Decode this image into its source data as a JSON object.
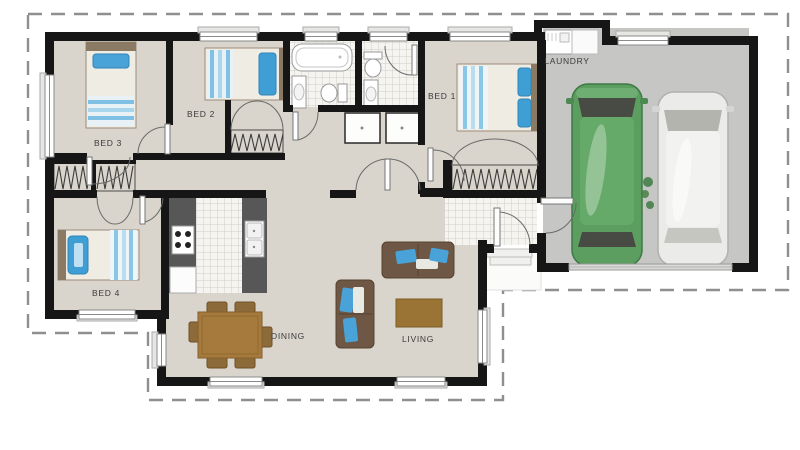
{
  "title": "Single storey house floor plan with double garage",
  "rooms": {
    "bed1": "BED 1",
    "bed2": "BED 2",
    "bed3": "BED 3",
    "bed4": "BED 4",
    "dining": "DINING",
    "living": "LIVING",
    "laundry": "LAUNDRY"
  },
  "vehicles": {
    "left": "green-car",
    "right": "white-car"
  },
  "palette": {
    "wall": "#161616",
    "floor": "#d9d5cc",
    "garage_floor": "#c6c6c4",
    "tile": "#f5f4f1",
    "counter": "#575757",
    "wood": "#a6793d",
    "sofa_brown": "#6e5745",
    "cushion_blue": "#4aa3d8",
    "bed_blue": "#3f9fd4",
    "car_green": "#5b9e60",
    "car_white": "#ebebe9",
    "boundary_dash": "#8f8f8f"
  }
}
